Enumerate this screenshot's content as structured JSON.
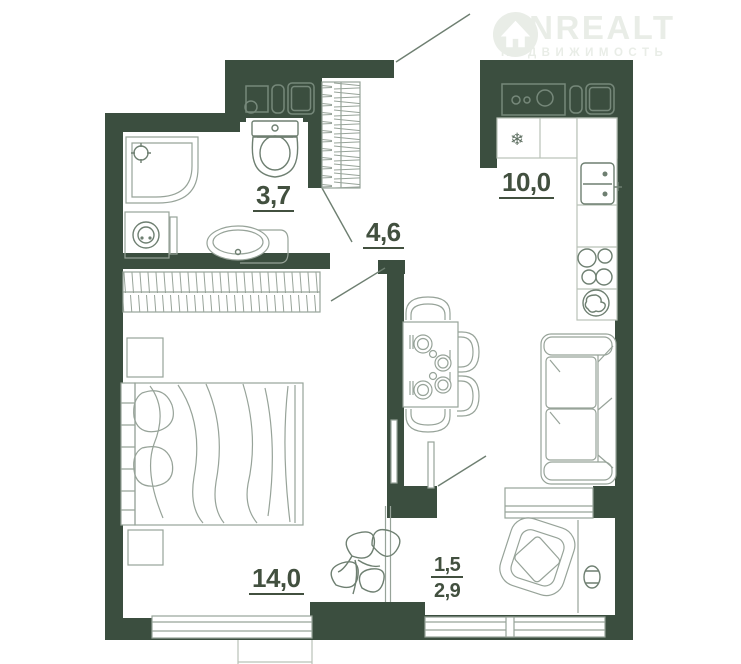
{
  "watermark": {
    "brand": "ONREALT",
    "tagline": "НЕДВИЖИМОСТЬ",
    "icon": "house-in-circle-icon"
  },
  "rooms": {
    "bathroom": {
      "area": "3,7"
    },
    "hallway": {
      "area": "4,6"
    },
    "kitchen": {
      "area": "10,0"
    },
    "bedroom": {
      "area": "14,0"
    },
    "balcony": {
      "area_counted": "1,5",
      "area_total": "2,9"
    }
  },
  "icons": {
    "snowflake": "❄"
  },
  "palette": {
    "wall": "#3b4e3f",
    "furniture_line": "#97a399",
    "furniture_line_dark": "#6e7f71",
    "counter_border": "#b9c2b8",
    "label_text": "#42503f",
    "watermark": "#e9ede7",
    "background": "#ffffff"
  },
  "furniture": [
    "corner-shower",
    "washing-machine",
    "bathroom-sink",
    "toilet",
    "utility-shaft",
    "hall-wardrobe",
    "entrance-door",
    "bathroom-door",
    "bedroom-door",
    "kitchen-counter",
    "fridge",
    "kitchen-sink",
    "stove",
    "round-sink",
    "dining-table",
    "dining-chairs",
    "tableware",
    "sofa",
    "bedroom-wardrobe",
    "nightstand",
    "bed",
    "plant",
    "balcony-door",
    "armchair",
    "flower-pot",
    "window"
  ]
}
